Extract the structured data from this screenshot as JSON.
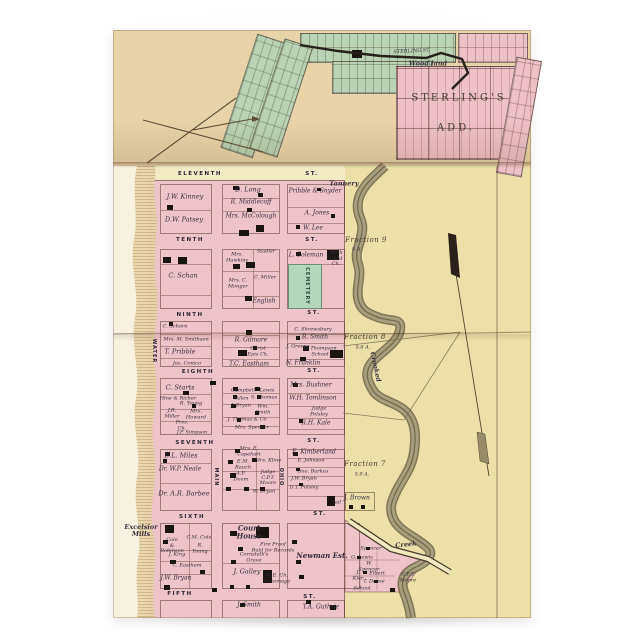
{
  "image_kind": "greeting card product photo of a vintage town plat map",
  "palette": {
    "card_white": "#f9f9f7",
    "paper_tan_top": "#e8d3a8",
    "paper_cream": "#f2ebc6",
    "open_land_yellow": "#ece0a8",
    "block_pink": "#eec3c9",
    "subdivision_green": "#b9d3b4",
    "cemetery_green": "#b4d6bd",
    "creek_olive": "#a89f7d",
    "ink": "#352b3c"
  },
  "map": {
    "labels": [
      {
        "t": "STERLING ST.",
        "x": 412,
        "y": 52,
        "k": "t",
        "r": -3,
        "n": "street-label-sterling"
      },
      {
        "t": "Wood land",
        "x": 428,
        "y": 64,
        "k": "c",
        "n": "label-woodland"
      },
      {
        "t": "STERLING'S",
        "x": 459,
        "y": 98,
        "k": "b",
        "n": "label-sterlings-add"
      },
      {
        "t": "ADD.",
        "x": 456,
        "y": 128,
        "k": "b",
        "n": "label-sterlings-add2"
      },
      {
        "t": "ELEVENTH",
        "x": 200,
        "y": 174,
        "k": "s",
        "n": "street-eleventh"
      },
      {
        "t": "ST.",
        "x": 312,
        "y": 174,
        "k": "s"
      },
      {
        "t": "TENTH",
        "x": 190,
        "y": 240,
        "k": "s",
        "n": "street-tenth"
      },
      {
        "t": "ST.",
        "x": 312,
        "y": 240,
        "k": "s"
      },
      {
        "t": "NINTH",
        "x": 190,
        "y": 315,
        "k": "s",
        "n": "street-ninth"
      },
      {
        "t": "ST.",
        "x": 314,
        "y": 313,
        "k": "s"
      },
      {
        "t": "EIGHTH",
        "x": 198,
        "y": 372,
        "k": "s",
        "n": "street-eighth"
      },
      {
        "t": "ST.",
        "x": 314,
        "y": 371,
        "k": "s"
      },
      {
        "t": "SEVENTH",
        "x": 195,
        "y": 443,
        "k": "s",
        "n": "street-seventh"
      },
      {
        "t": "ST.",
        "x": 314,
        "y": 441,
        "k": "s"
      },
      {
        "t": "SIXTH",
        "x": 192,
        "y": 517,
        "k": "s",
        "n": "street-sixth"
      },
      {
        "t": "ST.",
        "x": 320,
        "y": 514,
        "k": "s"
      },
      {
        "t": "FIFTH",
        "x": 180,
        "y": 594,
        "k": "s",
        "n": "street-fifth"
      },
      {
        "t": "ST.",
        "x": 310,
        "y": 597,
        "k": "s"
      },
      {
        "t": "WATER",
        "x": 153,
        "y": 351,
        "k": "v",
        "n": "street-water"
      },
      {
        "t": "MAIN",
        "x": 215,
        "y": 477,
        "k": "v",
        "n": "street-main"
      },
      {
        "t": "OHIO",
        "x": 280,
        "y": 477,
        "k": "v",
        "n": "street-ohio"
      },
      {
        "t": "CEMETERY",
        "x": 306,
        "y": 286,
        "k": "vg",
        "n": "label-cemetery"
      },
      {
        "t": "J.W. Kinney",
        "x": 185,
        "y": 197,
        "k": "n7"
      },
      {
        "t": "D.W. Patsey",
        "x": 184,
        "y": 220,
        "k": "n7"
      },
      {
        "t": "D. Long",
        "x": 248,
        "y": 190,
        "k": "n7"
      },
      {
        "t": "R. Middlecoff",
        "x": 251,
        "y": 203,
        "k": "n"
      },
      {
        "t": "Mrs. McColough",
        "x": 251,
        "y": 217,
        "k": "n"
      },
      {
        "t": "Pribble & Snyder",
        "x": 315,
        "y": 192,
        "k": "n"
      },
      {
        "t": "A. Jones",
        "x": 317,
        "y": 214,
        "k": "n"
      },
      {
        "t": "W. Lee",
        "x": 313,
        "y": 229,
        "k": "n"
      },
      {
        "t": "Tannery",
        "x": 344,
        "y": 184,
        "k": "c"
      },
      {
        "t": "C. Schan",
        "x": 183,
        "y": 276,
        "k": "n7"
      },
      {
        "t": "Mrs.\nHawkins",
        "x": 237,
        "y": 258,
        "k": "t"
      },
      {
        "t": "Stadler",
        "x": 266,
        "y": 252,
        "k": "t"
      },
      {
        "t": "Mrs. C.\nMonger",
        "x": 238,
        "y": 284,
        "k": "t"
      },
      {
        "t": "C. Miller",
        "x": 265,
        "y": 278,
        "k": "t"
      },
      {
        "t": "English",
        "x": 264,
        "y": 302,
        "k": "n"
      },
      {
        "t": "L. Coleman",
        "x": 306,
        "y": 256,
        "k": "n"
      },
      {
        "t": "Meth\nCol'd\nCh.",
        "x": 336,
        "y": 259,
        "k": "t"
      },
      {
        "t": "C. Schorn",
        "x": 175,
        "y": 327,
        "k": "t"
      },
      {
        "t": "Mrs. M. Smithson",
        "x": 186,
        "y": 340,
        "k": "t"
      },
      {
        "t": "T. Pribble",
        "x": 180,
        "y": 352,
        "k": "n7"
      },
      {
        "t": "Jas. Conico",
        "x": 187,
        "y": 364,
        "k": "t"
      },
      {
        "t": "R. Gilmore",
        "x": 251,
        "y": 341,
        "k": "n"
      },
      {
        "t": "Christ\nEpis Ch.",
        "x": 258,
        "y": 352,
        "k": "t"
      },
      {
        "t": "T.C. Eastham",
        "x": 249,
        "y": 365,
        "k": "n"
      },
      {
        "t": "C. Shrewsbury",
        "x": 313,
        "y": 330,
        "k": "t"
      },
      {
        "t": "R. Smith",
        "x": 315,
        "y": 338,
        "k": "n"
      },
      {
        "t": "J. Greene",
        "x": 298,
        "y": 347,
        "k": "t"
      },
      {
        "t": "R. Thompson",
        "x": 320,
        "y": 349,
        "k": "t"
      },
      {
        "t": "School",
        "x": 320,
        "y": 355,
        "k": "t"
      },
      {
        "t": "N. Franklin",
        "x": 303,
        "y": 364,
        "k": "n"
      },
      {
        "t": "C. Starts",
        "x": 180,
        "y": 388,
        "k": "n7"
      },
      {
        "t": "Hine & Richer",
        "x": 178,
        "y": 399,
        "k": "t"
      },
      {
        "t": "R. Young",
        "x": 191,
        "y": 404,
        "k": "t"
      },
      {
        "t": "J.R.\nMiller",
        "x": 172,
        "y": 414,
        "k": "t"
      },
      {
        "t": "Mrs.\nHoward",
        "x": 196,
        "y": 415,
        "k": "t"
      },
      {
        "t": "Pres.\nCh.",
        "x": 182,
        "y": 426,
        "k": "t"
      },
      {
        "t": "J.P. Simpson",
        "x": 192,
        "y": 433,
        "k": "t"
      },
      {
        "t": "Campbell",
        "x": 243,
        "y": 391,
        "k": "t"
      },
      {
        "t": "Lewis",
        "x": 267,
        "y": 391,
        "k": "t"
      },
      {
        "t": "Allen",
        "x": 242,
        "y": 399,
        "k": "t"
      },
      {
        "t": "S. Thomas",
        "x": 264,
        "y": 398,
        "k": "t"
      },
      {
        "t": "J. Bryan",
        "x": 241,
        "y": 406,
        "k": "t"
      },
      {
        "t": "Wm.\nSmith",
        "x": 263,
        "y": 410,
        "k": "t"
      },
      {
        "t": "J. Thomas & Co",
        "x": 247,
        "y": 420,
        "k": "t"
      },
      {
        "t": "Mrs. Spencer",
        "x": 252,
        "y": 428,
        "k": "t"
      },
      {
        "t": "Mrs. Bushner",
        "x": 311,
        "y": 386,
        "k": "n"
      },
      {
        "t": "W.H. Tomlinson",
        "x": 313,
        "y": 399,
        "k": "n"
      },
      {
        "t": "Judge\nPolsley",
        "x": 319,
        "y": 412,
        "k": "t"
      },
      {
        "t": "R.H. Kale",
        "x": 316,
        "y": 424,
        "k": "n"
      },
      {
        "t": "B.L. Miles",
        "x": 181,
        "y": 456,
        "k": "n7"
      },
      {
        "t": "Dr. W.P. Neale",
        "x": 180,
        "y": 470,
        "k": "n"
      },
      {
        "t": "Dr. A.R. Barbee",
        "x": 184,
        "y": 494,
        "k": "n7"
      },
      {
        "t": "Mrs. E.\nCapehart",
        "x": 249,
        "y": 452,
        "k": "t"
      },
      {
        "t": "Mrs. Kline",
        "x": 268,
        "y": 461,
        "k": "t"
      },
      {
        "t": "E.M.\nRauch",
        "x": 243,
        "y": 465,
        "k": "t"
      },
      {
        "t": "A.F.\nDeem",
        "x": 241,
        "y": 477,
        "k": "t"
      },
      {
        "t": "Judge\nC.P.T.\nMoore",
        "x": 268,
        "y": 478,
        "k": "t"
      },
      {
        "t": "W. Bryan",
        "x": 264,
        "y": 492,
        "k": "t"
      },
      {
        "t": "E. Kimberland",
        "x": 314,
        "y": 453,
        "k": "n"
      },
      {
        "t": "E. Johnson",
        "x": 311,
        "y": 461,
        "k": "t"
      },
      {
        "t": "Geo. Barkus",
        "x": 313,
        "y": 472,
        "k": "t"
      },
      {
        "t": "J.W. Bryan",
        "x": 304,
        "y": 479,
        "k": "t"
      },
      {
        "t": "D.T. Polsley",
        "x": 304,
        "y": 488,
        "k": "t"
      },
      {
        "t": "Jail",
        "x": 337,
        "y": 503,
        "k": "t"
      },
      {
        "t": "J. Brown",
        "x": 357,
        "y": 499,
        "k": "n"
      },
      {
        "t": "Excelsior\nMills",
        "x": 141,
        "y": 531,
        "k": "c"
      },
      {
        "t": "Cole\n&\nRobinson",
        "x": 172,
        "y": 546,
        "k": "t"
      },
      {
        "t": "C.M. Cole",
        "x": 199,
        "y": 538,
        "k": "t"
      },
      {
        "t": "R.\nYoung",
        "x": 200,
        "y": 549,
        "k": "t"
      },
      {
        "t": "J. King",
        "x": 177,
        "y": 555,
        "k": "t"
      },
      {
        "t": "C. Eastham",
        "x": 187,
        "y": 566,
        "k": "t"
      },
      {
        "t": "J.W. Bryan",
        "x": 176,
        "y": 579,
        "k": "n"
      },
      {
        "t": "Court\nHouse",
        "x": 249,
        "y": 532,
        "k": "h"
      },
      {
        "t": "Fire Proof\nBuld for Records",
        "x": 273,
        "y": 548,
        "k": "t"
      },
      {
        "t": "Cornstalk's\nGrave",
        "x": 254,
        "y": 558,
        "k": "t"
      },
      {
        "t": "J. Galley",
        "x": 247,
        "y": 572,
        "k": "n7"
      },
      {
        "t": "M.E. Ch.\nParsonage",
        "x": 277,
        "y": 579,
        "k": "t"
      },
      {
        "t": "Newman Est.",
        "x": 322,
        "y": 556,
        "k": "h"
      },
      {
        "t": "Spencer",
        "x": 371,
        "y": 549,
        "k": "t"
      },
      {
        "t": "G. Lewis",
        "x": 362,
        "y": 558,
        "k": "t"
      },
      {
        "t": "W.\nSpencer",
        "x": 369,
        "y": 567,
        "k": "t"
      },
      {
        "t": "J.\nKler",
        "x": 358,
        "y": 576,
        "k": "t"
      },
      {
        "t": "Elbert",
        "x": 377,
        "y": 574,
        "k": "t"
      },
      {
        "t": "T. Deave",
        "x": 374,
        "y": 582,
        "k": "t"
      },
      {
        "t": "School",
        "x": 362,
        "y": 589,
        "k": "t"
      },
      {
        "t": "C.P.T.\nMoore",
        "x": 408,
        "y": 578,
        "k": "t"
      },
      {
        "t": "J. Smith",
        "x": 249,
        "y": 606,
        "k": "n"
      },
      {
        "t": "T.A. Guthrie",
        "x": 321,
        "y": 608,
        "k": "n"
      },
      {
        "t": "Fraction 9",
        "x": 366,
        "y": 241,
        "k": "f"
      },
      {
        "t": "8 A.",
        "x": 357,
        "y": 250,
        "k": "t"
      },
      {
        "t": "Fraction 8",
        "x": 365,
        "y": 338,
        "k": "f"
      },
      {
        "t": "5.6 A.",
        "x": 363,
        "y": 348,
        "k": "t"
      },
      {
        "t": "Fraction 7",
        "x": 365,
        "y": 465,
        "k": "f"
      },
      {
        "t": "5.9 A.",
        "x": 362,
        "y": 475,
        "k": "t"
      },
      {
        "t": "Creek",
        "x": 406,
        "y": 545,
        "k": "c",
        "r": -6,
        "n": "label-creek"
      },
      {
        "t": "Crooked",
        "x": 375,
        "y": 367,
        "k": "c",
        "r": 78,
        "n": "label-crooked"
      }
    ],
    "buildings": [
      [
        167,
        205,
        6,
        5
      ],
      [
        233,
        186,
        6,
        4
      ],
      [
        258,
        193,
        5,
        4
      ],
      [
        247,
        208,
        5,
        4
      ],
      [
        256,
        225,
        8,
        7
      ],
      [
        239,
        230,
        10,
        6
      ],
      [
        317,
        188,
        4,
        3
      ],
      [
        331,
        214,
        4,
        4
      ],
      [
        296,
        225,
        4,
        4
      ],
      [
        352,
        50,
        10,
        8
      ],
      [
        163,
        257,
        8,
        6
      ],
      [
        178,
        257,
        9,
        7
      ],
      [
        233,
        264,
        7,
        5
      ],
      [
        246,
        262,
        9,
        6
      ],
      [
        296,
        252,
        5,
        4
      ],
      [
        327,
        250,
        12,
        10
      ],
      [
        245,
        296,
        7,
        5
      ],
      [
        169,
        322,
        4,
        4
      ],
      [
        246,
        330,
        6,
        5
      ],
      [
        238,
        350,
        9,
        6
      ],
      [
        253,
        346,
        4,
        4
      ],
      [
        296,
        336,
        4,
        4
      ],
      [
        303,
        346,
        6,
        5
      ],
      [
        330,
        350,
        13,
        8
      ],
      [
        300,
        357,
        6,
        4
      ],
      [
        210,
        381,
        6,
        4
      ],
      [
        183,
        391,
        6,
        4
      ],
      [
        192,
        404,
        4,
        4
      ],
      [
        233,
        387,
        5,
        4
      ],
      [
        255,
        387,
        5,
        4
      ],
      [
        233,
        395,
        4,
        4
      ],
      [
        257,
        395,
        4,
        4
      ],
      [
        231,
        404,
        5,
        4
      ],
      [
        255,
        411,
        4,
        4
      ],
      [
        237,
        418,
        4,
        4
      ],
      [
        260,
        425,
        5,
        4
      ],
      [
        293,
        383,
        5,
        4
      ],
      [
        299,
        419,
        4,
        4
      ],
      [
        165,
        452,
        5,
        4
      ],
      [
        163,
        459,
        4,
        4
      ],
      [
        235,
        449,
        5,
        4
      ],
      [
        228,
        460,
        5,
        4
      ],
      [
        252,
        458,
        5,
        4
      ],
      [
        230,
        473,
        6,
        5
      ],
      [
        226,
        487,
        5,
        4
      ],
      [
        244,
        487,
        5,
        4
      ],
      [
        260,
        487,
        5,
        4
      ],
      [
        293,
        452,
        5,
        4
      ],
      [
        296,
        468,
        4,
        3
      ],
      [
        299,
        483,
        4,
        3
      ],
      [
        327,
        496,
        8,
        10
      ],
      [
        349,
        505,
        4,
        4
      ],
      [
        361,
        505,
        4,
        4
      ],
      [
        165,
        525,
        9,
        8
      ],
      [
        230,
        531,
        7,
        5
      ],
      [
        256,
        527,
        13,
        11
      ],
      [
        292,
        540,
        5,
        4
      ],
      [
        238,
        547,
        5,
        4
      ],
      [
        163,
        540,
        5,
        4
      ],
      [
        231,
        560,
        5,
        4
      ],
      [
        296,
        560,
        5,
        4
      ],
      [
        170,
        560,
        6,
        4
      ],
      [
        200,
        570,
        5,
        4
      ],
      [
        299,
        575,
        5,
        4
      ],
      [
        263,
        570,
        9,
        13
      ],
      [
        246,
        585,
        4,
        4
      ],
      [
        230,
        585,
        4,
        4
      ],
      [
        164,
        585,
        6,
        5
      ],
      [
        212,
        588,
        5,
        4
      ],
      [
        306,
        600,
        5,
        4
      ],
      [
        240,
        603,
        5,
        4
      ],
      [
        330,
        605,
        6,
        5
      ],
      [
        366,
        547,
        4,
        3
      ],
      [
        357,
        556,
        4,
        3
      ],
      [
        363,
        571,
        4,
        3
      ],
      [
        374,
        580,
        4,
        3
      ],
      [
        390,
        588,
        5,
        4
      ]
    ]
  }
}
